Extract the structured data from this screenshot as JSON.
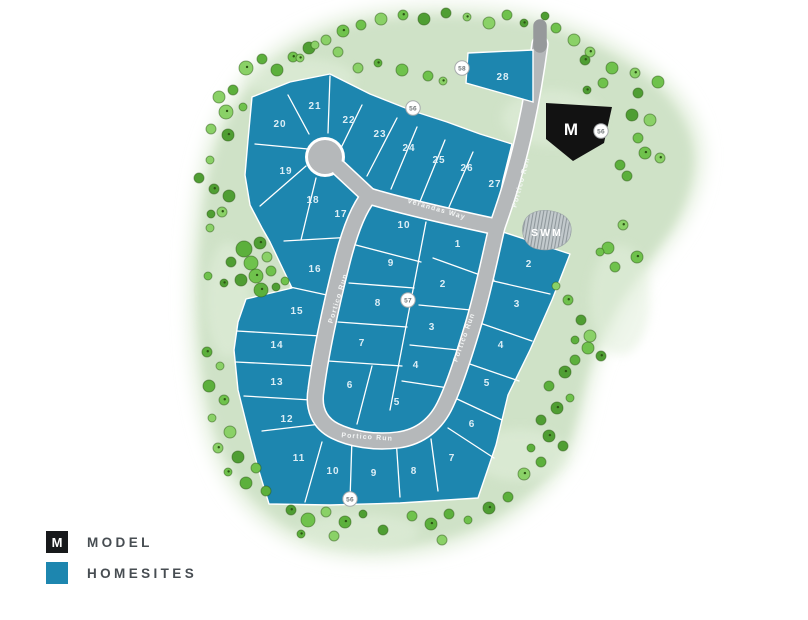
{
  "map": {
    "model_marker": {
      "label": "M",
      "badge": "56"
    },
    "swm": {
      "label": "SWM"
    },
    "roads": {
      "portico_run": "Portico Run",
      "verandas_way": "Verandas Way"
    },
    "badges": {
      "b58": "58",
      "b56_top": "56",
      "b57": "57",
      "b56_bottom": "56"
    },
    "lots": {
      "top_row": [
        "20",
        "21",
        "22",
        "23",
        "24",
        "25",
        "26",
        "27"
      ],
      "northeast": [
        "28"
      ],
      "left_column": [
        "19",
        "18",
        "17",
        "16",
        "15",
        "14",
        "13",
        "12"
      ],
      "bottom_row": [
        "11",
        "10",
        "9",
        "8",
        "7"
      ],
      "east_column": [
        "2",
        "3",
        "4",
        "5",
        "6"
      ],
      "inner_left": [
        "10",
        "9",
        "8",
        "7",
        "6",
        "5"
      ],
      "inner_right": [
        "1",
        "2",
        "3",
        "4"
      ]
    }
  },
  "legend": {
    "items": [
      {
        "symbol": "M",
        "label": "MODEL"
      },
      {
        "symbol": "",
        "label": "HOMESITES"
      }
    ]
  },
  "colors": {
    "homesite": "#1d86af",
    "model": "#121212",
    "road": "#b5b8ba",
    "green": "#cfe2c7"
  }
}
